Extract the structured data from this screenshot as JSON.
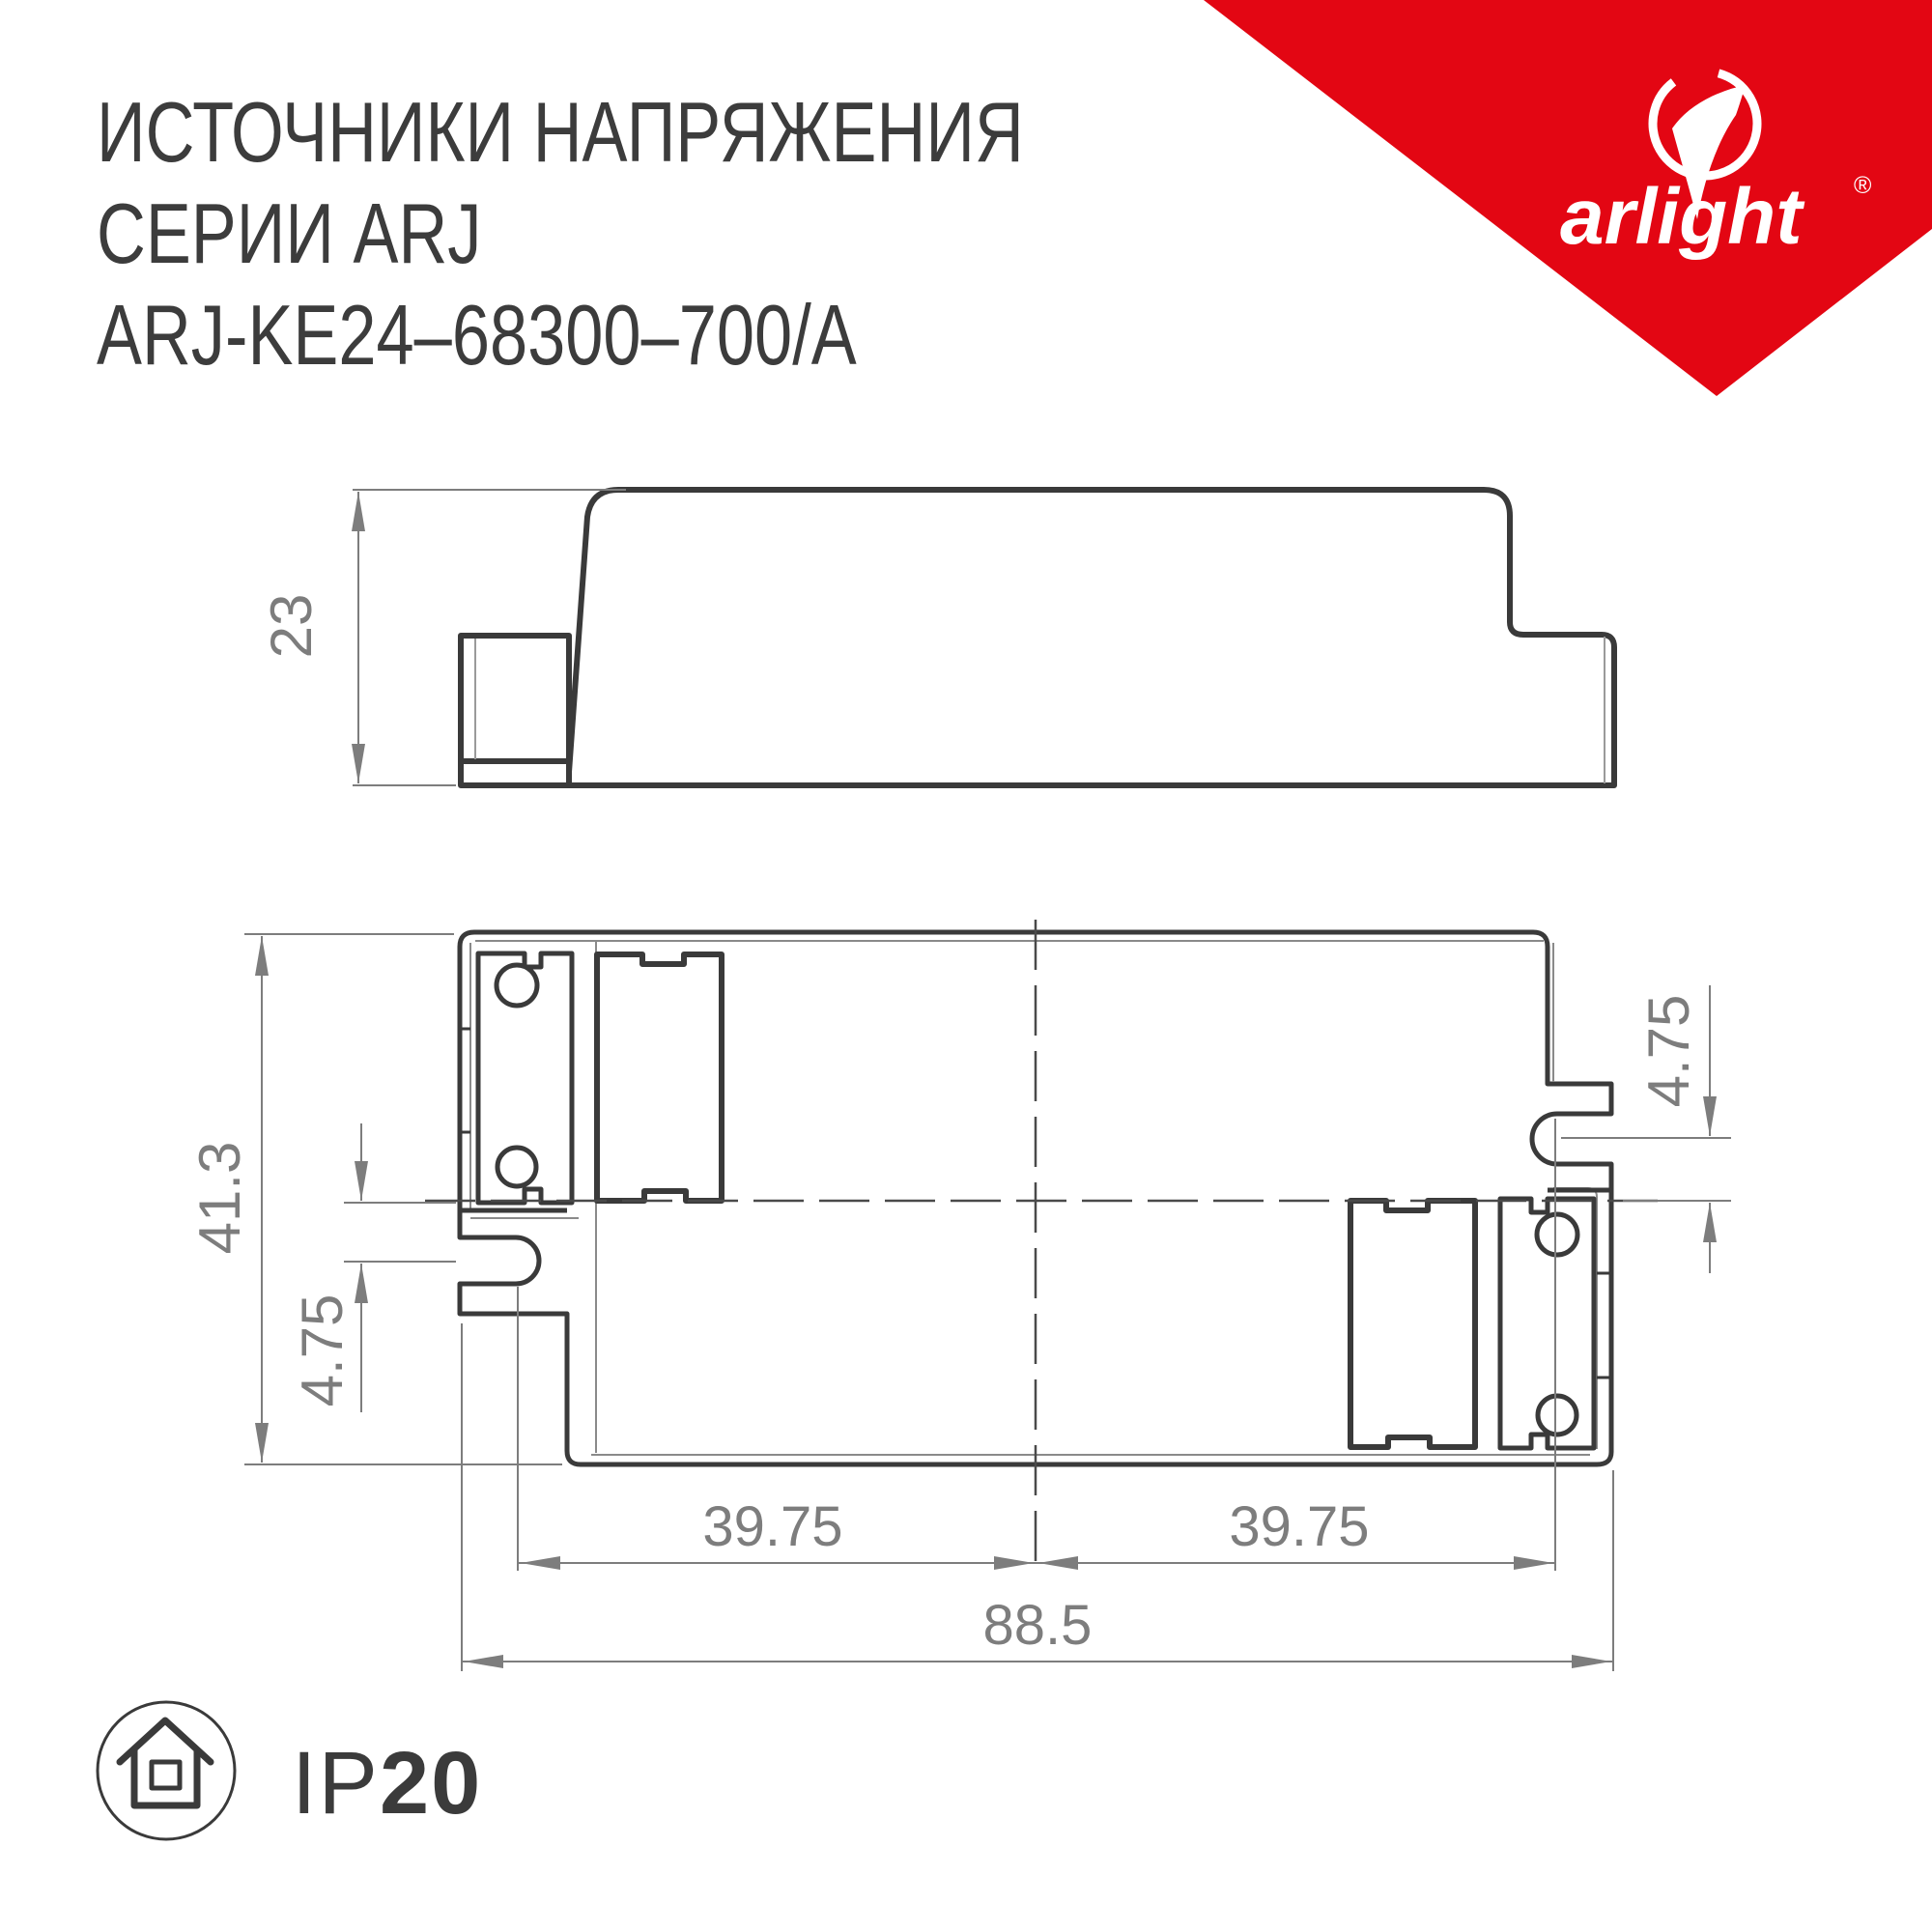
{
  "header": {
    "title_line1": "ИСТОЧНИКИ НАПРЯЖЕНИЯ",
    "title_line2": "СЕРИИ ARJ",
    "title_line3": "ARJ-KE24–68300–700/A"
  },
  "brand": {
    "logo_text": "arlight",
    "registered_mark": "®",
    "triangle_color": "#e30613"
  },
  "drawing": {
    "side_view": {
      "height_dim": "23"
    },
    "top_view": {
      "overall_height_dim": "41.3",
      "slot_offset_left_dim": "4.75",
      "slot_offset_right_dim": "4.75",
      "hole_span_left_dim": "39.75",
      "hole_span_right_dim": "39.75",
      "overall_width_dim": "88.5"
    }
  },
  "footer": {
    "ip_rating_prefix": "IP",
    "ip_rating_value": "20"
  },
  "colors": {
    "line": "#3a3a3a",
    "dimension": "#7d7d7d",
    "accent_red": "#e30613"
  }
}
